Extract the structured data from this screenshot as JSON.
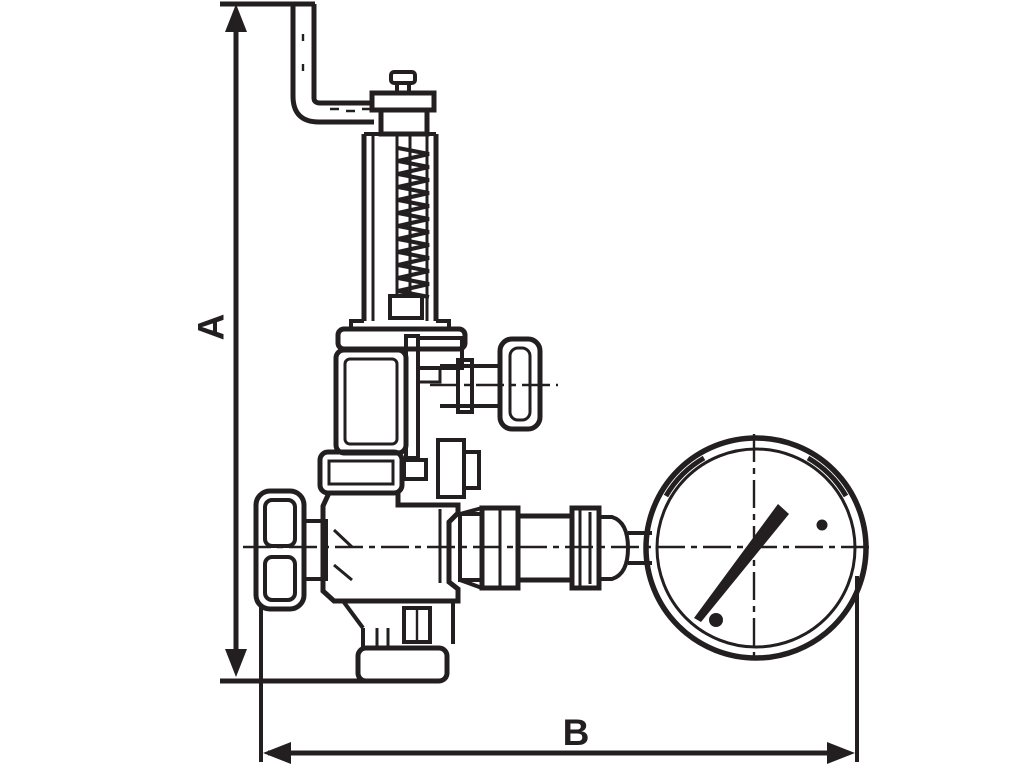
{
  "drawing": {
    "colors": {
      "line": "#231f20",
      "background": "#ffffff"
    },
    "dimensions": {
      "a": {
        "label": "A",
        "orientation": "vertical"
      },
      "b": {
        "label": "B",
        "orientation": "horizontal"
      }
    },
    "parts": [
      "lifting-lever",
      "spindle-cap",
      "spring-bonnet",
      "spring-coil",
      "upper-body",
      "test-knob",
      "mid-flange",
      "handwheel",
      "valve-body",
      "inlet-flange",
      "outlet-union",
      "gauge-connection",
      "pressure-gauge",
      "gauge-needle"
    ]
  }
}
